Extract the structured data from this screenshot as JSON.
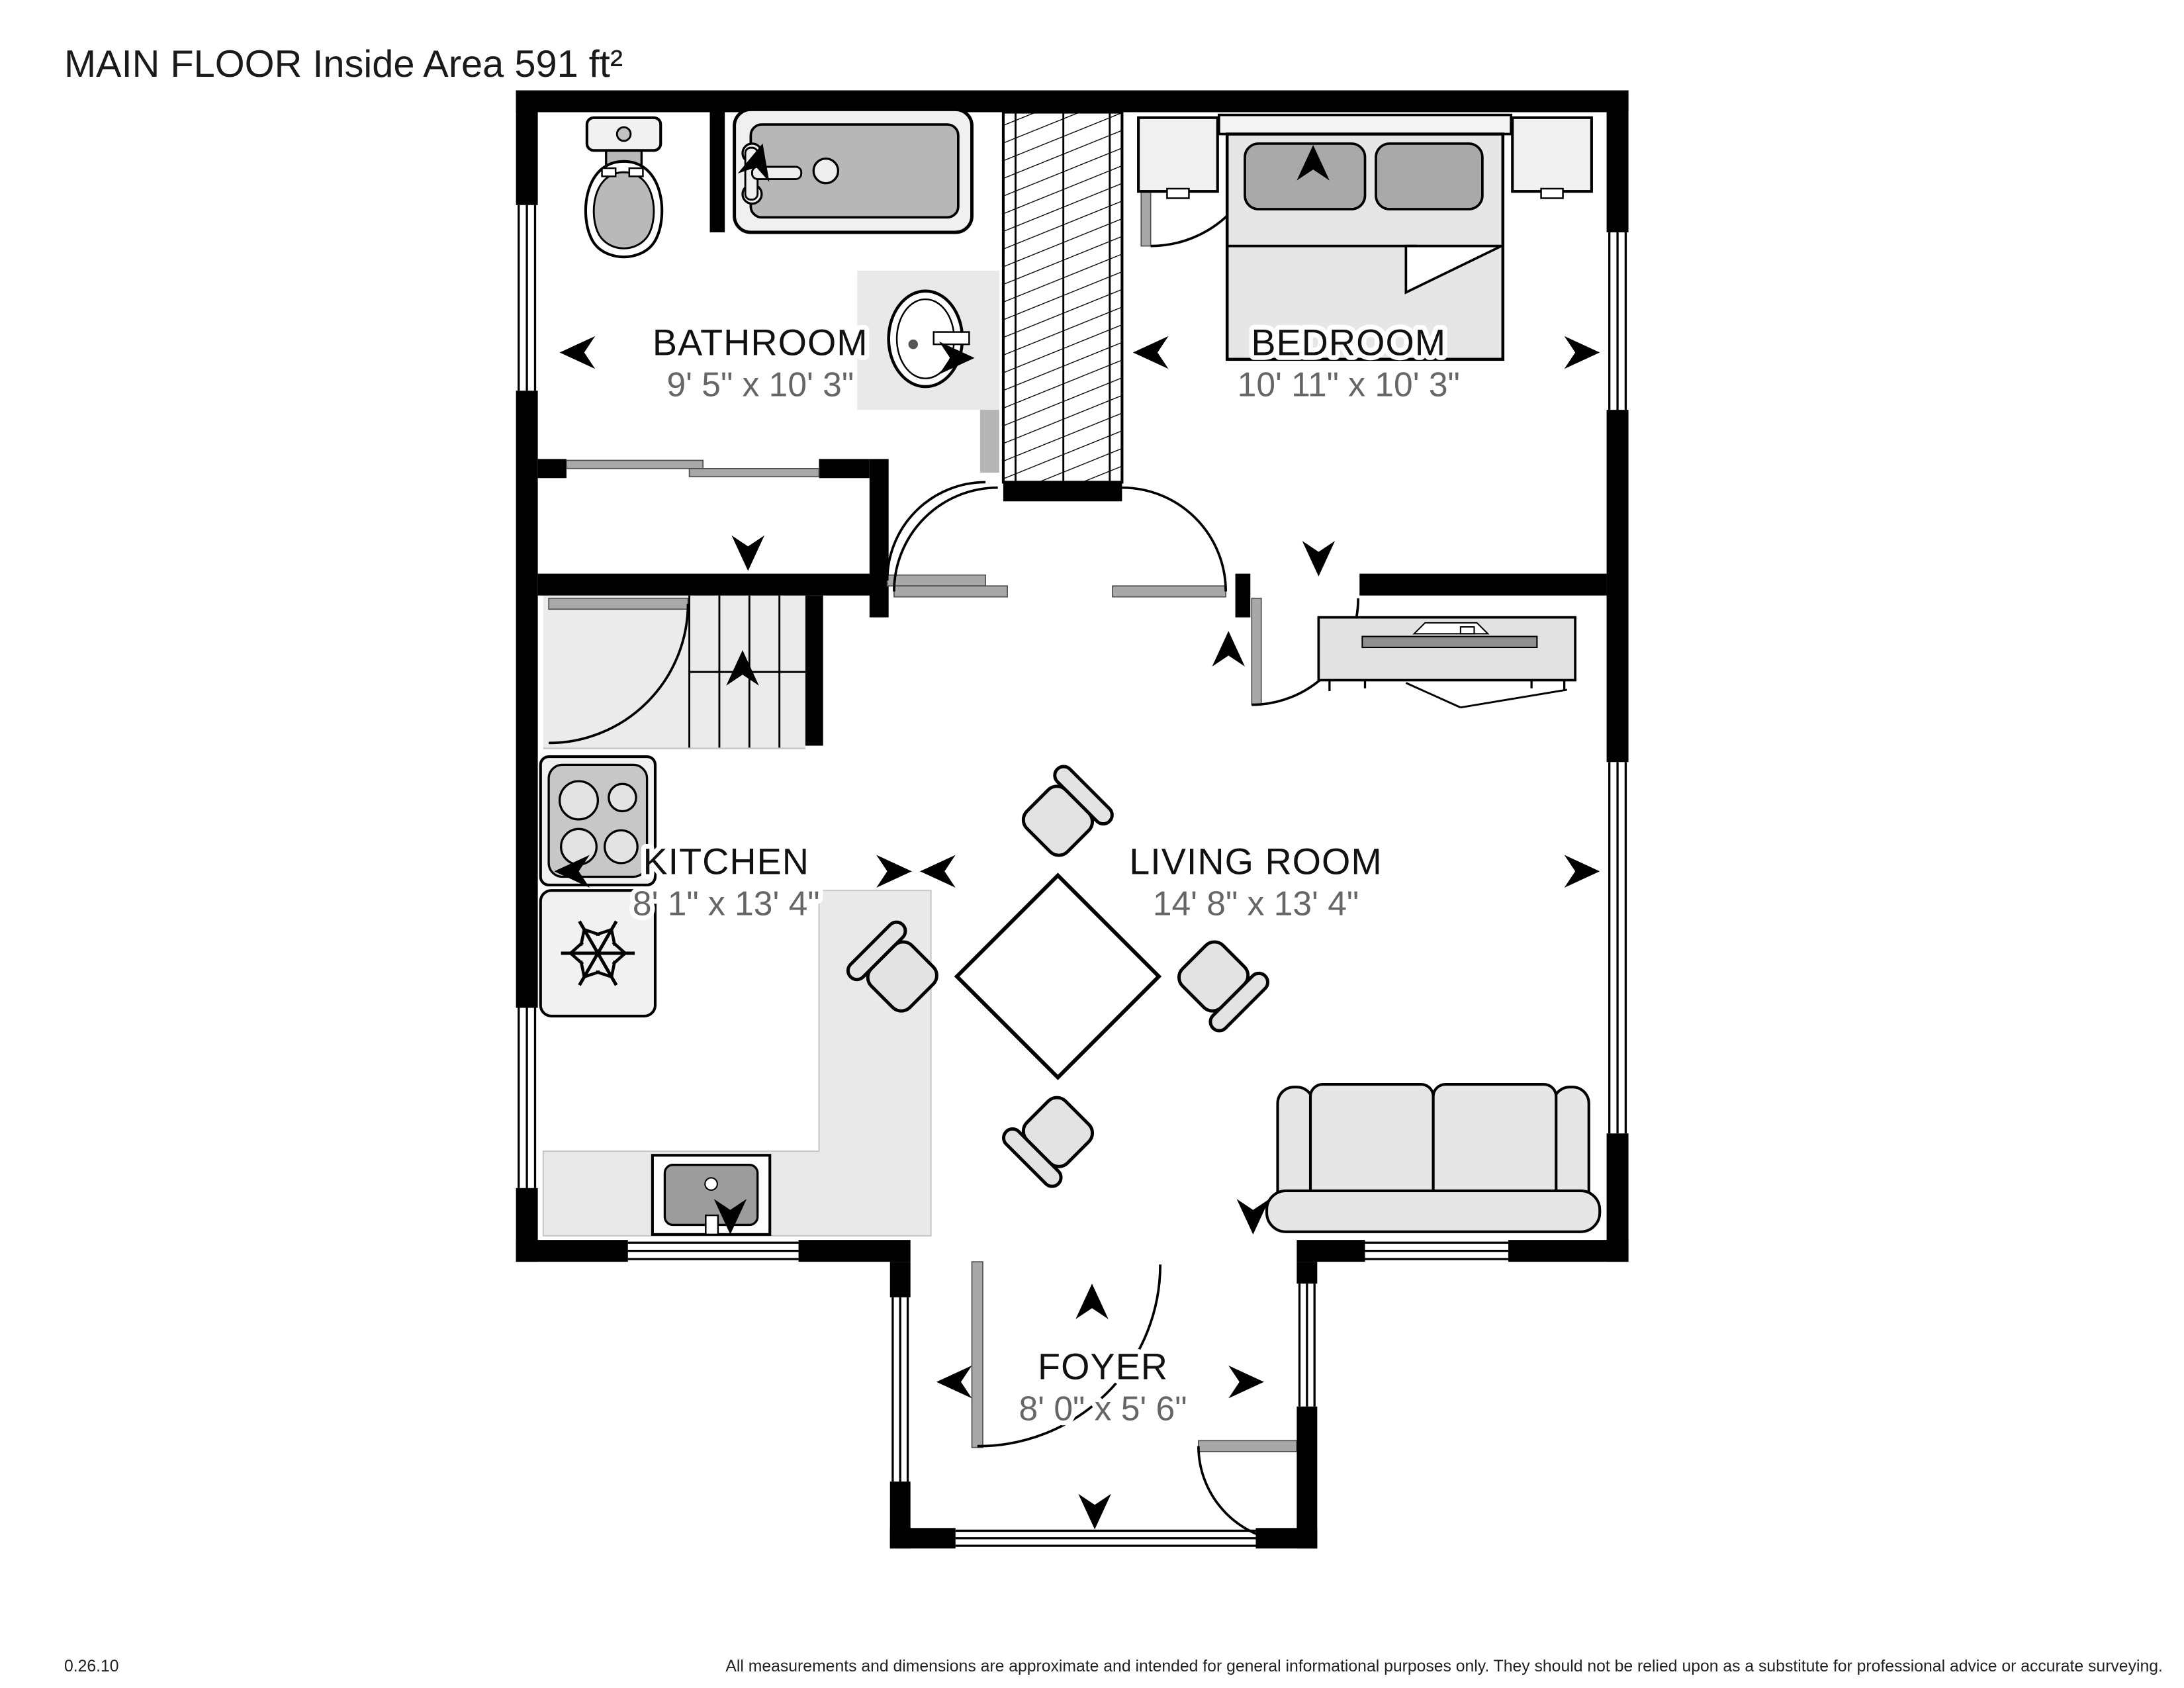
{
  "title": "MAIN FLOOR Inside Area 591 ft²",
  "rooms": [
    {
      "name": "BATHROOM",
      "dimensions": "9' 5\" x 10' 3\""
    },
    {
      "name": "BEDROOM",
      "dimensions": "10' 11\" x 10' 3\""
    },
    {
      "name": "KITCHEN",
      "dimensions": "8' 1\" x 13' 4\""
    },
    {
      "name": "LIVING ROOM",
      "dimensions": "14' 8\" x 13' 4\""
    },
    {
      "name": "FOYER",
      "dimensions": "8' 0\" x 5' 6\""
    }
  ],
  "footer": {
    "version": "0.26.10",
    "disclaimer": "All measurements and dimensions are approximate and intended for general informational purposes only. They should not be relied upon as a substitute for professional advice or accurate surveying."
  },
  "colors": {
    "wall": "#000000",
    "furniture_fill": "#e6e6e6",
    "appliance_panel": "#c7c7c7",
    "tub_interior": "#b7b7b7",
    "pillow": "#a9a9a9",
    "counter": "#e9e9e9",
    "room_text": "#111111",
    "dimension_text": "#666666"
  }
}
